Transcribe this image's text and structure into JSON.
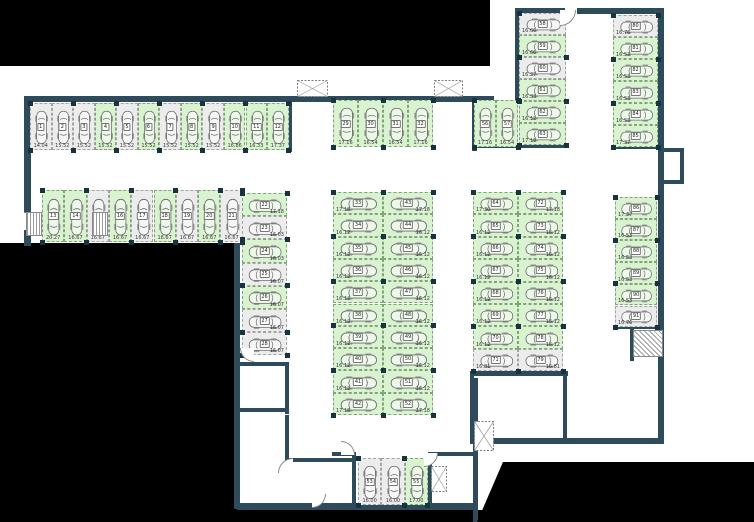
{
  "plan_title": "underground parking level plan",
  "colors": {
    "wall": "#2d4b5a",
    "available_space": "#d9f2d0",
    "occupied_space": "#ececec",
    "void": "#000000"
  },
  "parking": {
    "groups": [
      {
        "id": "top-left-row",
        "spaces": [
          {
            "num": "1",
            "area": "14.04",
            "highlight": false
          },
          {
            "num": "2",
            "area": "15.52",
            "highlight": false
          },
          {
            "num": "3",
            "area": "15.52",
            "highlight": false
          },
          {
            "num": "4",
            "area": "15.52",
            "highlight": true
          },
          {
            "num": "5",
            "area": "15.52",
            "highlight": false
          },
          {
            "num": "6",
            "area": "15.52",
            "highlight": true
          },
          {
            "num": "7",
            "area": "15.52",
            "highlight": false
          },
          {
            "num": "8",
            "area": "15.52",
            "highlight": true
          },
          {
            "num": "9",
            "area": "15.52",
            "highlight": false
          },
          {
            "num": "10",
            "area": "16.86",
            "highlight": true
          },
          {
            "num": "11",
            "area": "16.33",
            "highlight": true
          },
          {
            "num": "12",
            "area": "17.37",
            "highlight": true
          }
        ]
      },
      {
        "id": "second-row",
        "spaces": [
          {
            "num": "13",
            "area": "20.27",
            "highlight": true
          },
          {
            "num": "14",
            "area": "16.67",
            "highlight": true
          },
          {
            "num": "15",
            "area": "16.67",
            "highlight": false
          },
          {
            "num": "16",
            "area": "16.67",
            "highlight": true
          },
          {
            "num": "17",
            "area": "16.67",
            "highlight": false
          },
          {
            "num": "18",
            "area": "16.67",
            "highlight": true
          },
          {
            "num": "19",
            "area": "16.67",
            "highlight": false
          },
          {
            "num": "20",
            "area": "16.67",
            "highlight": true
          },
          {
            "num": "21",
            "area": "16.67",
            "highlight": false
          }
        ]
      },
      {
        "id": "left-inner-column",
        "spaces": [
          {
            "num": "22",
            "area": "17.18",
            "highlight": true
          },
          {
            "num": "23",
            "area": "16.03",
            "highlight": false
          },
          {
            "num": "24",
            "area": "16.03",
            "highlight": true
          },
          {
            "num": "25",
            "area": "16.07",
            "highlight": false
          },
          {
            "num": "26",
            "area": "16.07",
            "highlight": true
          },
          {
            "num": "27",
            "area": "16.07",
            "highlight": false
          },
          {
            "num": "28",
            "area": "16.07",
            "highlight": false
          }
        ]
      },
      {
        "id": "top-middle-row",
        "spaces": [
          {
            "num": "29",
            "area": "17.16",
            "highlight": true
          },
          {
            "num": "30",
            "area": "16.54",
            "highlight": true
          },
          {
            "num": "31",
            "area": "16.54",
            "highlight": true
          },
          {
            "num": "32",
            "area": "17.16",
            "highlight": true
          }
        ]
      },
      {
        "id": "center-left-column",
        "spaces": [
          {
            "num": "33",
            "area": "17.18",
            "highlight": true
          },
          {
            "num": "34",
            "area": "16.12",
            "highlight": true
          },
          {
            "num": "35",
            "area": "16.12",
            "highlight": true
          },
          {
            "num": "36",
            "area": "16.12",
            "highlight": true
          },
          {
            "num": "37",
            "area": "16.12",
            "highlight": true
          },
          {
            "num": "38",
            "area": "16.12",
            "highlight": true
          },
          {
            "num": "39",
            "area": "16.12",
            "highlight": true
          },
          {
            "num": "40",
            "area": "16.12",
            "highlight": true
          },
          {
            "num": "41",
            "area": "16.12",
            "highlight": true
          },
          {
            "num": "42",
            "area": "17.18",
            "highlight": true
          }
        ]
      },
      {
        "id": "center-right-column",
        "spaces": [
          {
            "num": "43",
            "area": "17.18",
            "highlight": true
          },
          {
            "num": "44",
            "area": "16.12",
            "highlight": true
          },
          {
            "num": "45",
            "area": "16.12",
            "highlight": true
          },
          {
            "num": "46",
            "area": "16.12",
            "highlight": true
          },
          {
            "num": "47",
            "area": "16.12",
            "highlight": true
          },
          {
            "num": "48",
            "area": "16.12",
            "highlight": true
          },
          {
            "num": "49",
            "area": "16.12",
            "highlight": true
          },
          {
            "num": "50",
            "area": "16.12",
            "highlight": true
          },
          {
            "num": "51",
            "area": "16.12",
            "highlight": true
          },
          {
            "num": "52",
            "area": "17.18",
            "highlight": true
          }
        ]
      },
      {
        "id": "bottom-middle-row",
        "spaces": [
          {
            "num": "53",
            "area": "16.00",
            "highlight": false
          },
          {
            "num": "54",
            "area": "16.00",
            "highlight": false
          },
          {
            "num": "55",
            "area": "17.00",
            "highlight": true
          }
        ]
      },
      {
        "id": "top-right-pair",
        "spaces": [
          {
            "num": "56",
            "area": "17.16",
            "highlight": true
          },
          {
            "num": "57",
            "area": "16.54",
            "highlight": true
          }
        ]
      },
      {
        "id": "top-right-column",
        "spaces": [
          {
            "num": "58",
            "area": "16.66",
            "highlight": false
          },
          {
            "num": "59",
            "area": "16.66",
            "highlight": true
          },
          {
            "num": "60",
            "area": "16.27",
            "highlight": false
          },
          {
            "num": "61",
            "area": "16.33",
            "highlight": true
          },
          {
            "num": "62",
            "area": "16.12",
            "highlight": true
          },
          {
            "num": "63",
            "area": "17.18",
            "highlight": true
          }
        ]
      },
      {
        "id": "right-inner-left-column",
        "spaces": [
          {
            "num": "64",
            "area": "17.30",
            "highlight": true
          },
          {
            "num": "65",
            "area": "16.12",
            "highlight": true
          },
          {
            "num": "66",
            "area": "16.12",
            "highlight": true
          },
          {
            "num": "67",
            "area": "16.12",
            "highlight": true
          },
          {
            "num": "68",
            "area": "16.12",
            "highlight": true
          },
          {
            "num": "69",
            "area": "16.12",
            "highlight": true
          },
          {
            "num": "70",
            "area": "16.12",
            "highlight": true
          },
          {
            "num": "71",
            "area": "16.81",
            "highlight": false
          }
        ]
      },
      {
        "id": "right-inner-right-column",
        "spaces": [
          {
            "num": "72",
            "area": "17.18",
            "highlight": true
          },
          {
            "num": "73",
            "area": "16.12",
            "highlight": true
          },
          {
            "num": "74",
            "area": "16.12",
            "highlight": true
          },
          {
            "num": "75",
            "area": "16.12",
            "highlight": true
          },
          {
            "num": "76",
            "area": "16.12",
            "highlight": true
          },
          {
            "num": "77",
            "area": "16.12",
            "highlight": true
          },
          {
            "num": "78",
            "area": "16.12",
            "highlight": true
          },
          {
            "num": "79",
            "area": "16.81",
            "highlight": false
          }
        ]
      },
      {
        "id": "far-right-top-column",
        "spaces": [
          {
            "num": "80",
            "area": "16.76",
            "highlight": false
          },
          {
            "num": "81",
            "area": "16.53",
            "highlight": true
          },
          {
            "num": "82",
            "area": "16.53",
            "highlight": true
          },
          {
            "num": "83",
            "area": "16.53",
            "highlight": true
          },
          {
            "num": "84",
            "area": "16.53",
            "highlight": true
          },
          {
            "num": "85",
            "area": "17.37",
            "highlight": true
          }
        ]
      },
      {
        "id": "far-right-bottom-column",
        "spaces": [
          {
            "num": "86",
            "area": "17.37",
            "highlight": true
          },
          {
            "num": "87",
            "area": "16.53",
            "highlight": true
          },
          {
            "num": "88",
            "area": "16.53",
            "highlight": true
          },
          {
            "num": "89",
            "area": "16.53",
            "highlight": true
          },
          {
            "num": "90",
            "area": "16.53",
            "highlight": true
          },
          {
            "num": "91",
            "area": "16.76",
            "highlight": false
          }
        ]
      }
    ]
  }
}
